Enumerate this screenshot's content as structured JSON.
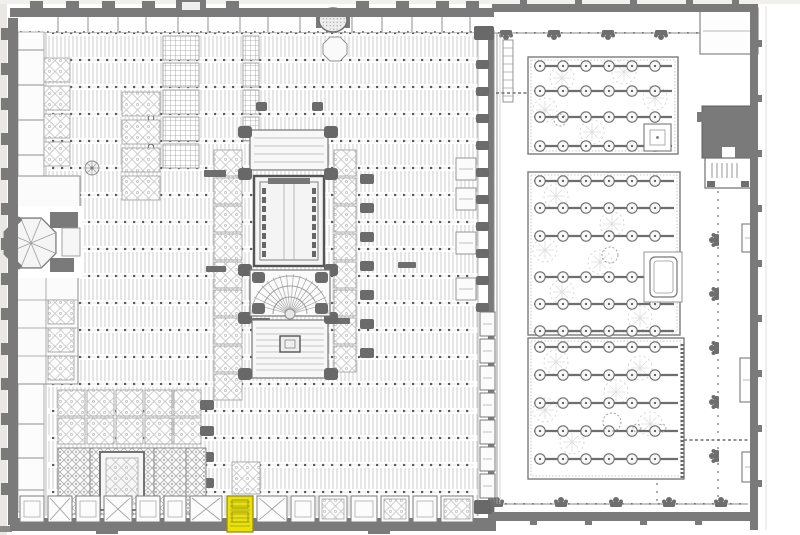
{
  "title": "Scanned floor plan: Mosque-Cathedral of Cordoba (hypostyle hall, inserted cathedral, Courtyard of the Orange Trees) with one south-wall chapel highlighted in yellow",
  "canvas": {
    "w": 800,
    "h": 535,
    "bg": "#ffffff",
    "edge": "#eae8e4",
    "edge2": "#f2f0ed"
  },
  "palette": {
    "wall": "#7a7a7a",
    "wall_dark": "#646464",
    "line": "#8f8f8f",
    "line_light": "#c9c9c9",
    "dot": "#5c5c5c",
    "ornate": "#b2b2b2",
    "fill": "#f6f6f6",
    "tree": "#6e6e6e",
    "foliage": "#d2d2d2"
  },
  "highlight": {
    "x": 227,
    "y": 496,
    "w": 26,
    "h": 36,
    "fill": "#ebe104",
    "stroke": "#938e1c",
    "detail": "#a19b33"
  },
  "hall": {
    "bands": {
      "x0": 46,
      "x1": 478,
      "y0": 36,
      "rows": 18,
      "step": 27,
      "h": 21
    },
    "dots": {
      "x0": 52,
      "x1": 474,
      "y0": 33,
      "rows": 18,
      "step": 27,
      "spacing": 9,
      "size": 2.2
    },
    "circles": [
      [
        151,
        118
      ],
      [
        151,
        147
      ]
    ],
    "west_wall": {
      "x": 8,
      "y": 18,
      "w": 10,
      "h": 507,
      "buttress_ys": [
        28,
        63,
        98,
        133,
        168,
        203,
        238,
        273,
        308,
        343,
        378,
        413,
        448,
        483
      ]
    },
    "top_wall": {
      "x": 10,
      "y": 8,
      "w": 484,
      "h": 9,
      "gates": [
        30,
        66,
        102,
        142,
        226,
        356,
        396,
        436,
        466
      ],
      "big_gate": {
        "x": 176,
        "w": 30
      }
    },
    "corridor": {
      "x": 16,
      "y": 15,
      "w": 462,
      "h": 17,
      "dividers": [
        58,
        88,
        118,
        146,
        178,
        208,
        240,
        268,
        300,
        352,
        382,
        412,
        442,
        470
      ]
    },
    "south_wall": {
      "x": 10,
      "y": 518,
      "w": 486,
      "h": 13,
      "stubs": [
        [
          96,
          529,
          22,
          5
        ],
        [
          368,
          529,
          22,
          5
        ]
      ]
    },
    "east_wall": {
      "wx": 488,
      "wy": 30,
      "ww": 6,
      "wh": 490,
      "buttresses": {
        "x": 476,
        "w": 13,
        "h": 9,
        "ys": [
          60,
          87,
          114,
          141,
          168,
          195,
          222,
          249,
          276,
          303
        ]
      },
      "chapel_ys": [
        312,
        339,
        366,
        393,
        420,
        447,
        474
      ],
      "chapel": {
        "x": 480,
        "w": 15,
        "h": 24
      },
      "corners": [
        [
          474,
          26,
          20,
          14
        ],
        [
          474,
          500,
          20,
          14
        ]
      ]
    },
    "rooms_strip": {
      "x": 18,
      "y": 32,
      "w": 26,
      "h": 480,
      "lines": [
        50,
        85,
        120,
        155,
        424,
        458,
        490
      ]
    },
    "upper_room": {
      "x": 16,
      "y": 176,
      "w": 64,
      "h": 32
    },
    "sagrario": {
      "x": 16,
      "y": 272,
      "w": 62,
      "h": 112,
      "hlines": [
        300,
        328,
        356
      ],
      "vline": 46
    },
    "crosshatch": [
      {
        "x": 163,
        "w": 36,
        "h": 24,
        "ys": [
          36,
          63,
          90,
          117,
          144
        ]
      },
      {
        "x": 243,
        "w": 16,
        "h": 24,
        "ys": [
          36,
          63,
          90,
          117
        ]
      }
    ],
    "ornate_strips": [
      {
        "x": 44,
        "w": 26,
        "h": 24,
        "ys": [
          58,
          86,
          114,
          142
        ]
      },
      {
        "x": 48,
        "w": 26,
        "h": 24,
        "ys": [
          300,
          328,
          356
        ]
      },
      {
        "x": 122,
        "w": 38,
        "h": 24,
        "ys": [
          92,
          120,
          148,
          176
        ]
      },
      {
        "x": 214,
        "w": 28,
        "h": 26,
        "ys": [
          150,
          178,
          206,
          234,
          262,
          290,
          318,
          346,
          374
        ]
      },
      {
        "x": 334,
        "w": 22,
        "h": 26,
        "ys": [
          150,
          178,
          206,
          234,
          262,
          290,
          318,
          346
        ]
      },
      {
        "x": 58,
        "w": 27,
        "h": 26,
        "ys": [
          390,
          418
        ]
      },
      {
        "x": 87,
        "w": 27,
        "h": 26,
        "ys": [
          390,
          418
        ]
      },
      {
        "x": 116,
        "w": 27,
        "h": 26,
        "ys": [
          390,
          418
        ]
      },
      {
        "x": 145,
        "w": 27,
        "h": 26,
        "ys": [
          390,
          418
        ]
      },
      {
        "x": 174,
        "w": 27,
        "h": 26,
        "ys": [
          390,
          418
        ]
      },
      {
        "x": 232,
        "w": 28,
        "h": 32,
        "ys": [
          462
        ]
      }
    ],
    "wall_chapels": [
      {
        "x": 456,
        "y": 158,
        "w": 20,
        "h": 22
      },
      {
        "x": 456,
        "y": 188,
        "w": 20,
        "h": 22
      },
      {
        "x": 456,
        "y": 232,
        "w": 20,
        "h": 22
      },
      {
        "x": 456,
        "y": 278,
        "w": 20,
        "h": 22
      }
    ],
    "pier_lines": [
      {
        "x": 360,
        "w": 14,
        "h": 10,
        "ys": [
          174,
          203,
          232,
          261,
          290,
          319,
          348
        ]
      },
      {
        "x": 200,
        "w": 14,
        "h": 10,
        "ys": [
          400,
          426,
          452,
          478,
          504
        ]
      },
      {
        "x": 256,
        "w": 11,
        "h": 9,
        "ys": [
          102
        ]
      },
      {
        "x": 312,
        "w": 11,
        "h": 9,
        "ys": [
          102
        ]
      }
    ],
    "bars": [
      [
        398,
        262,
        18,
        6
      ],
      [
        330,
        318,
        20,
        6
      ],
      [
        204,
        170,
        22,
        7
      ],
      [
        252,
        318,
        18,
        6
      ],
      [
        206,
        266,
        20,
        6
      ]
    ],
    "rosette": {
      "cx": 92,
      "cy": 168,
      "r": 7
    },
    "oval_gate": {
      "cx": 333,
      "cy": 20,
      "rx": 14,
      "ry": 12
    },
    "octagon_bay": {
      "cx": 335,
      "cy": 49,
      "r": 13
    },
    "octagon": {
      "cx": 31,
      "cy": 243,
      "r": 27
    },
    "mihrab": {
      "x": 58,
      "y": 448,
      "w": 148,
      "h": 66,
      "dividers": [
        90,
        154,
        186
      ],
      "chapel": {
        "x": 100,
        "y": 452,
        "w": 44,
        "h": 58
      },
      "niche": {
        "x": 116,
        "y": 500,
        "w": 14,
        "h": 12
      }
    },
    "south_chapels": {
      "y": 496,
      "h": 26,
      "items": [
        {
          "x": 20,
          "w": 24,
          "s": "p"
        },
        {
          "x": 48,
          "w": 24,
          "s": "x"
        },
        {
          "x": 76,
          "w": 24,
          "s": "p"
        },
        {
          "x": 104,
          "w": 28,
          "s": "x"
        },
        {
          "x": 136,
          "w": 24,
          "s": "p"
        },
        {
          "x": 164,
          "w": 22,
          "s": "p"
        },
        {
          "x": 190,
          "w": 32,
          "s": "x"
        },
        {
          "x": 257,
          "w": 30,
          "s": "x"
        },
        {
          "x": 291,
          "w": 24,
          "s": "p"
        },
        {
          "x": 319,
          "w": 28,
          "s": "o"
        },
        {
          "x": 351,
          "w": 26,
          "s": "p"
        },
        {
          "x": 381,
          "w": 28,
          "s": "o"
        },
        {
          "x": 413,
          "w": 24,
          "s": "p"
        },
        {
          "x": 441,
          "w": 32,
          "s": "o"
        }
      ]
    }
  },
  "cathedral": {
    "transept": {
      "x": 250,
      "y": 130,
      "w": 78,
      "h": 40
    },
    "choir": {
      "x": 254,
      "y": 176,
      "w": 70,
      "h": 90
    },
    "crossing": {
      "x": 250,
      "y": 270,
      "w": 80,
      "h": 46,
      "fan_cx": 290,
      "fan_cy": 314
    },
    "chancel": {
      "x": 252,
      "y": 320,
      "w": 76,
      "h": 58
    },
    "altar": {
      "x": 280,
      "y": 336,
      "w": 20,
      "h": 16
    },
    "pier_chains": {
      "xs": [
        238,
        324
      ],
      "w": 14,
      "h": 12,
      "ys": [
        126,
        168,
        264,
        312,
        368
      ]
    }
  },
  "courtyard": {
    "top_wall": {
      "x": 492,
      "y": 4,
      "w": 266,
      "h": 8,
      "buttress_xs": [
        520,
        575,
        630,
        686,
        732
      ]
    },
    "right_wall": {
      "x": 750,
      "y": 4,
      "w": 8,
      "h": 526,
      "buttress_ys": [
        40,
        95,
        150,
        205,
        260,
        315,
        370,
        425,
        480
      ]
    },
    "bottom_wall": {
      "x": 492,
      "y": 512,
      "w": 262,
      "h": 9,
      "buttress_xs": [
        530,
        585,
        640,
        695
      ]
    },
    "arc_top": {
      "y": 33,
      "x0": 494,
      "x1": 748,
      "clusters": [
        506,
        554,
        608,
        661,
        713
      ],
      "dir": "down"
    },
    "arc_bottom": {
      "y": 504,
      "x0": 492,
      "x1": 748,
      "clusters": [
        497,
        561,
        616,
        669,
        721
      ],
      "dir": "up"
    },
    "arc_east": {
      "x": 716,
      "y0": 168,
      "y1": 500,
      "clusters": [
        240,
        294,
        348,
        402,
        456
      ],
      "dir": "left"
    },
    "west_gallery": {
      "x": 497,
      "y0": 33,
      "y1": 504
    },
    "stair": {
      "x": 503,
      "y": 40,
      "w": 10,
      "h": 62,
      "rung_step": 8
    },
    "gardens": [
      {
        "x": 528,
        "y": 57,
        "w": 150,
        "h": 97,
        "rows": [
          66,
          91,
          117,
          146
        ],
        "tree_step": 23,
        "blobs": [
          [
            562,
            78
          ],
          [
            624,
            72
          ],
          [
            592,
            132
          ],
          [
            655,
            98
          ],
          [
            545,
            110
          ]
        ],
        "annex": {
          "x": 644,
          "y": 124,
          "w": 27,
          "h": 27
        }
      },
      {
        "x": 528,
        "y": 172,
        "w": 152,
        "h": 163,
        "rows": [
          181,
          208,
          236,
          277,
          304,
          331
        ],
        "tree_step": 23,
        "blobs": [
          [
            556,
            196
          ],
          [
            612,
            224
          ],
          [
            562,
            292
          ],
          [
            640,
            318
          ],
          [
            600,
            262
          ],
          [
            545,
            250
          ]
        ],
        "notch": {
          "x": 644,
          "y": 252,
          "w": 38,
          "h": 50
        },
        "pool": {
          "x": 650,
          "y": 257,
          "w": 27,
          "h": 40
        }
      },
      {
        "x": 528,
        "y": 338,
        "w": 156,
        "h": 141,
        "rows": [
          347,
          375,
          403,
          431,
          459
        ],
        "tree_step": 23,
        "blobs": [
          [
            556,
            362
          ],
          [
            616,
            392
          ],
          [
            572,
            442
          ],
          [
            650,
            424
          ],
          [
            545,
            410
          ],
          [
            640,
            368
          ]
        ],
        "east_dash": {
          "x": 682,
          "y0": 344,
          "y1": 478
        }
      }
    ],
    "loose_circles": [
      [
        610,
        255,
        8
      ],
      [
        612,
        422,
        9
      ],
      [
        637,
        428,
        4
      ],
      [
        662,
        428,
        4
      ],
      [
        560,
        120,
        6
      ]
    ],
    "bell_tower": {
      "x": 702,
      "y": 106,
      "w": 54,
      "h": 52,
      "notch": {
        "x": 722,
        "y": 147,
        "w": 13,
        "h": 11
      },
      "lug": {
        "x": 697,
        "y": 112,
        "w": 6,
        "h": 10
      }
    },
    "gate": {
      "x": 705,
      "y": 158,
      "w": 46,
      "h": 30
    },
    "annex_rooms": [
      {
        "x": 700,
        "y": 8,
        "w": 58,
        "h": 46
      },
      {
        "x": 744,
        "y": 118,
        "w": 12,
        "h": 34
      },
      {
        "x": 742,
        "y": 224,
        "w": 14,
        "h": 28
      },
      {
        "x": 740,
        "y": 358,
        "w": 16,
        "h": 44
      },
      {
        "x": 742,
        "y": 452,
        "w": 14,
        "h": 30
      }
    ],
    "paths": {
      "dotted": [
        {
          "x": 657,
          "y0": 340,
          "y1": 500,
          "step": 8
        },
        {
          "x": 718,
          "y0": 168,
          "y1": 500,
          "step": 8
        }
      ],
      "dashed": [
        {
          "y": 440,
          "x0": 552,
          "x1": 749
        },
        {
          "y": 93,
          "x0": 496,
          "x1": 527
        }
      ]
    }
  }
}
